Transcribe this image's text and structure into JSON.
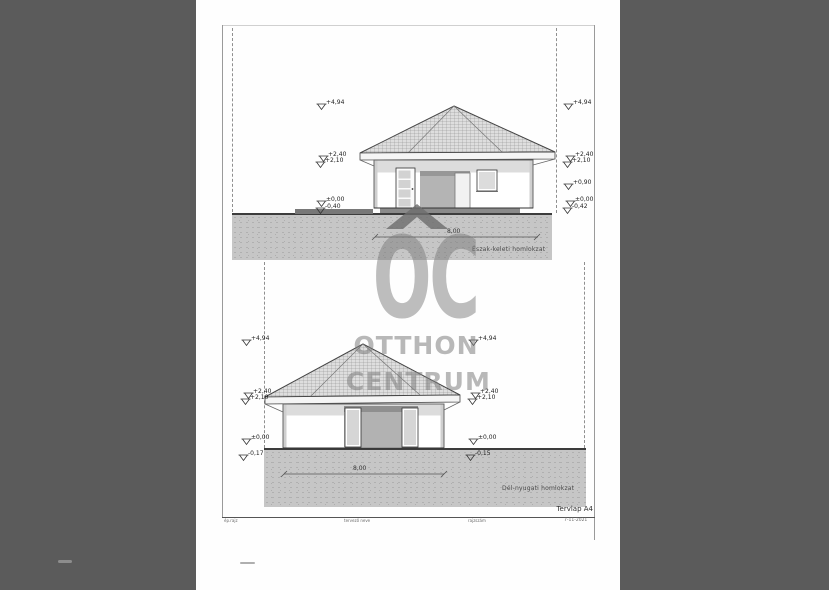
{
  "document": {
    "type_note": "scanned architectural elevation sheet",
    "paper_color": "#fefefe",
    "scanner_background": "#5b5b5b"
  },
  "watermark": {
    "oc": "OC",
    "otthon": "OTTHON",
    "centrum": "CENTRUM",
    "roof_icon_color": "#6e6e6e",
    "gray": "#7d7d7d"
  },
  "drawings": {
    "top": {
      "label": "Észak-keleti homlokzat",
      "dim": "8,00"
    },
    "bottom": {
      "label": "Dél-nyugati homlokzat",
      "dim": "8,00"
    }
  },
  "levels": {
    "top_left": [
      "+4,94",
      "+2,40",
      "+2,10",
      "±0,00",
      "-0,40"
    ],
    "top_right": [
      "+4,94",
      "+2,40",
      "+2,10",
      "+0,90",
      "±0,00",
      "-0,42"
    ],
    "bottom_left": [
      "+4,94",
      "+2,40",
      "+2,10",
      "±0,00",
      "-0,17"
    ],
    "bottom_right": [
      "+4,94",
      "+2,40",
      "+2,10",
      "±0,00",
      "-0,15"
    ]
  },
  "titleblock": {
    "sheet": "Tervlap A4",
    "date": "7-11-2021",
    "field1": "ép.rajz",
    "field2": "tervező neve",
    "field3": "rajzszám"
  }
}
